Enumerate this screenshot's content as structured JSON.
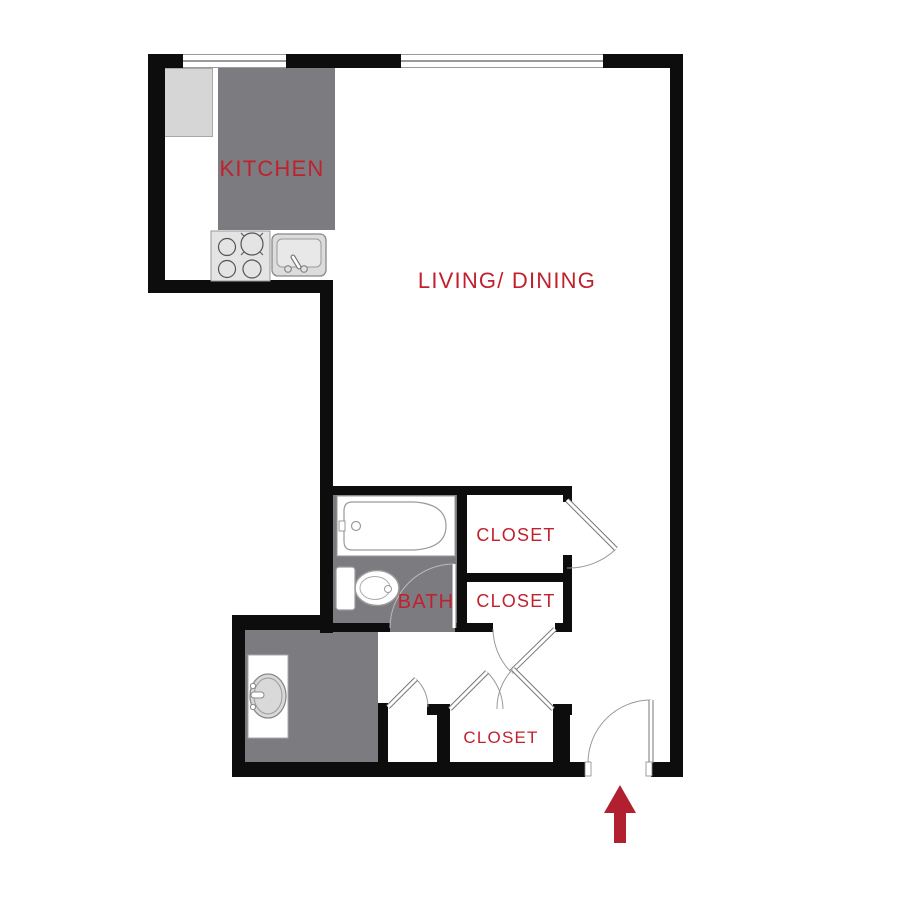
{
  "colors": {
    "wall": "#0d0d0d",
    "room": "#7b7b80",
    "appliance": "#d6d6d6",
    "red": "#c1202e",
    "arrow": "#b22030"
  },
  "floorplan": {
    "labels": {
      "kitchen": "KITCHEN",
      "living_dining": "LIVING/ DINING",
      "bath": "BATH",
      "closet_top": "CLOSET",
      "closet_middle": "CLOSET",
      "closet_bottom": "CLOSET"
    },
    "fixtures": [
      "refrigerator",
      "kitchen-counter",
      "stove-4-burners",
      "kitchen-sink",
      "bathtub",
      "toilet",
      "vanity-sink",
      "entry-arrow"
    ],
    "windows": 2,
    "doors": 7
  }
}
